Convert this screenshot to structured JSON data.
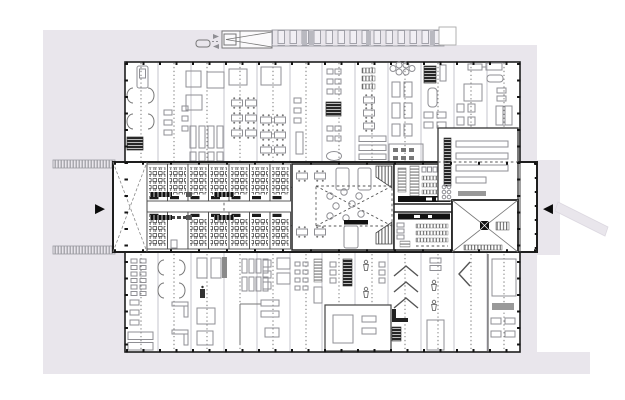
{
  "image": {
    "kind": "architectural floor plan",
    "description": "Ground-floor plan of a long rectangular building: light grey site apron with loading truck and canopy along the north edge, a central double-height band of classrooms and halls with entrance arrows on the west and east sides, and furnished room bays along the north and south wings"
  },
  "colors": {
    "paper": "#ffffff",
    "site": "#e9e6ec",
    "site_edge": "#dcd8e0",
    "wall": "#1e1e1e",
    "partition": "#555555",
    "grid": "#c6c4cc",
    "furniture": "#8f8f94",
    "furniture_dark": "#262626",
    "accent_black": "#0a0a0a"
  },
  "markers": {
    "west_entrance_arrow": "▶",
    "east_entrance_arrow": "◀"
  }
}
